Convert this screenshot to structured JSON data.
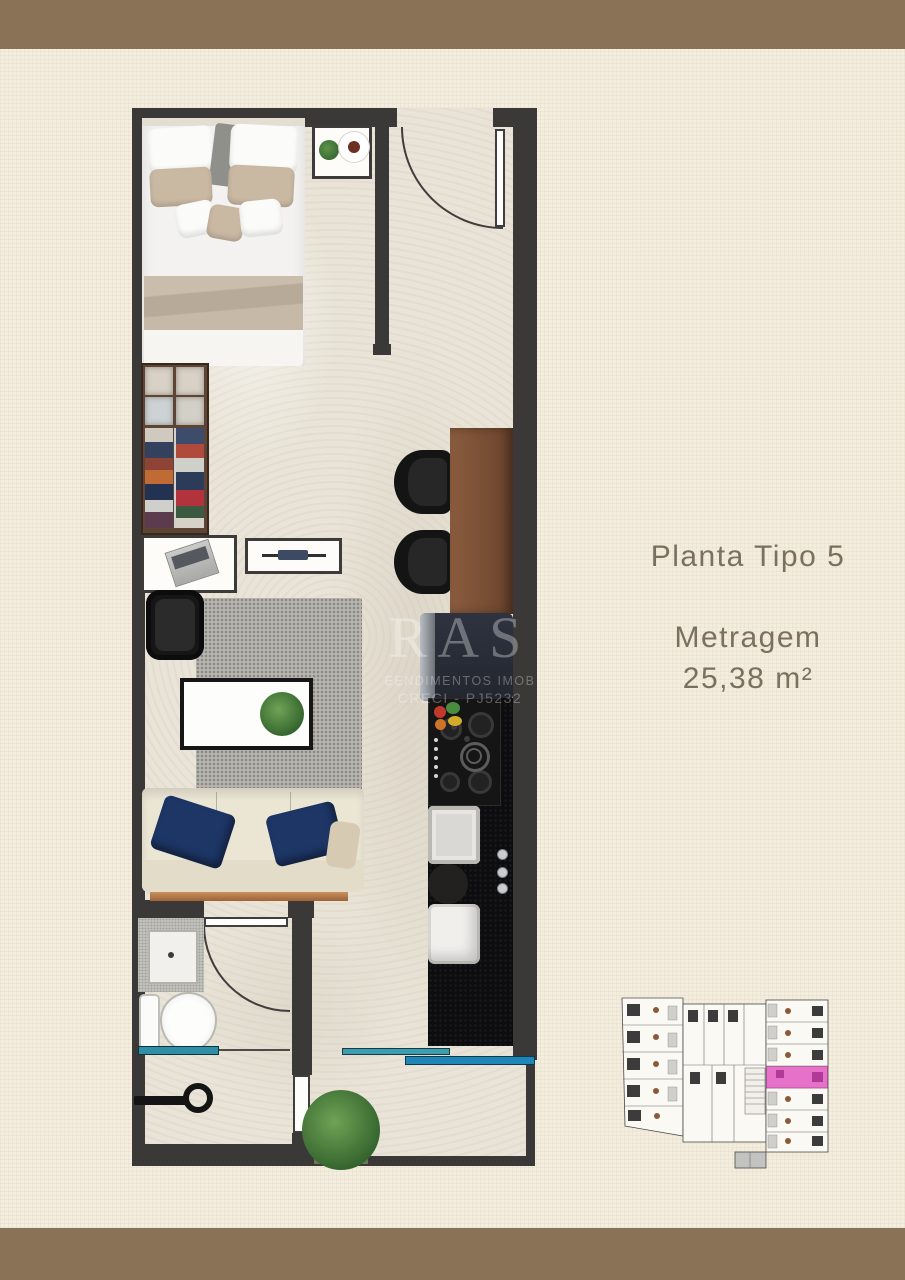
{
  "page": {
    "title": "Planta Tipo 5",
    "area_label": "Metragem",
    "area_value": "25,38 m²"
  },
  "watermark": {
    "line1": "RAS",
    "line2": "EENDIMENTOS IMOB",
    "line3": "CRECI - PJ5232"
  },
  "colors": {
    "border_brown": "#8A7256",
    "wall_dark": "#3A3938",
    "floor_beige": "#E9E4D7",
    "highlight_pink": "#E35FC3",
    "glass_teal": "#2E8FA6",
    "glass_blue": "#1F86B8",
    "text_brown": "#7B7060"
  }
}
